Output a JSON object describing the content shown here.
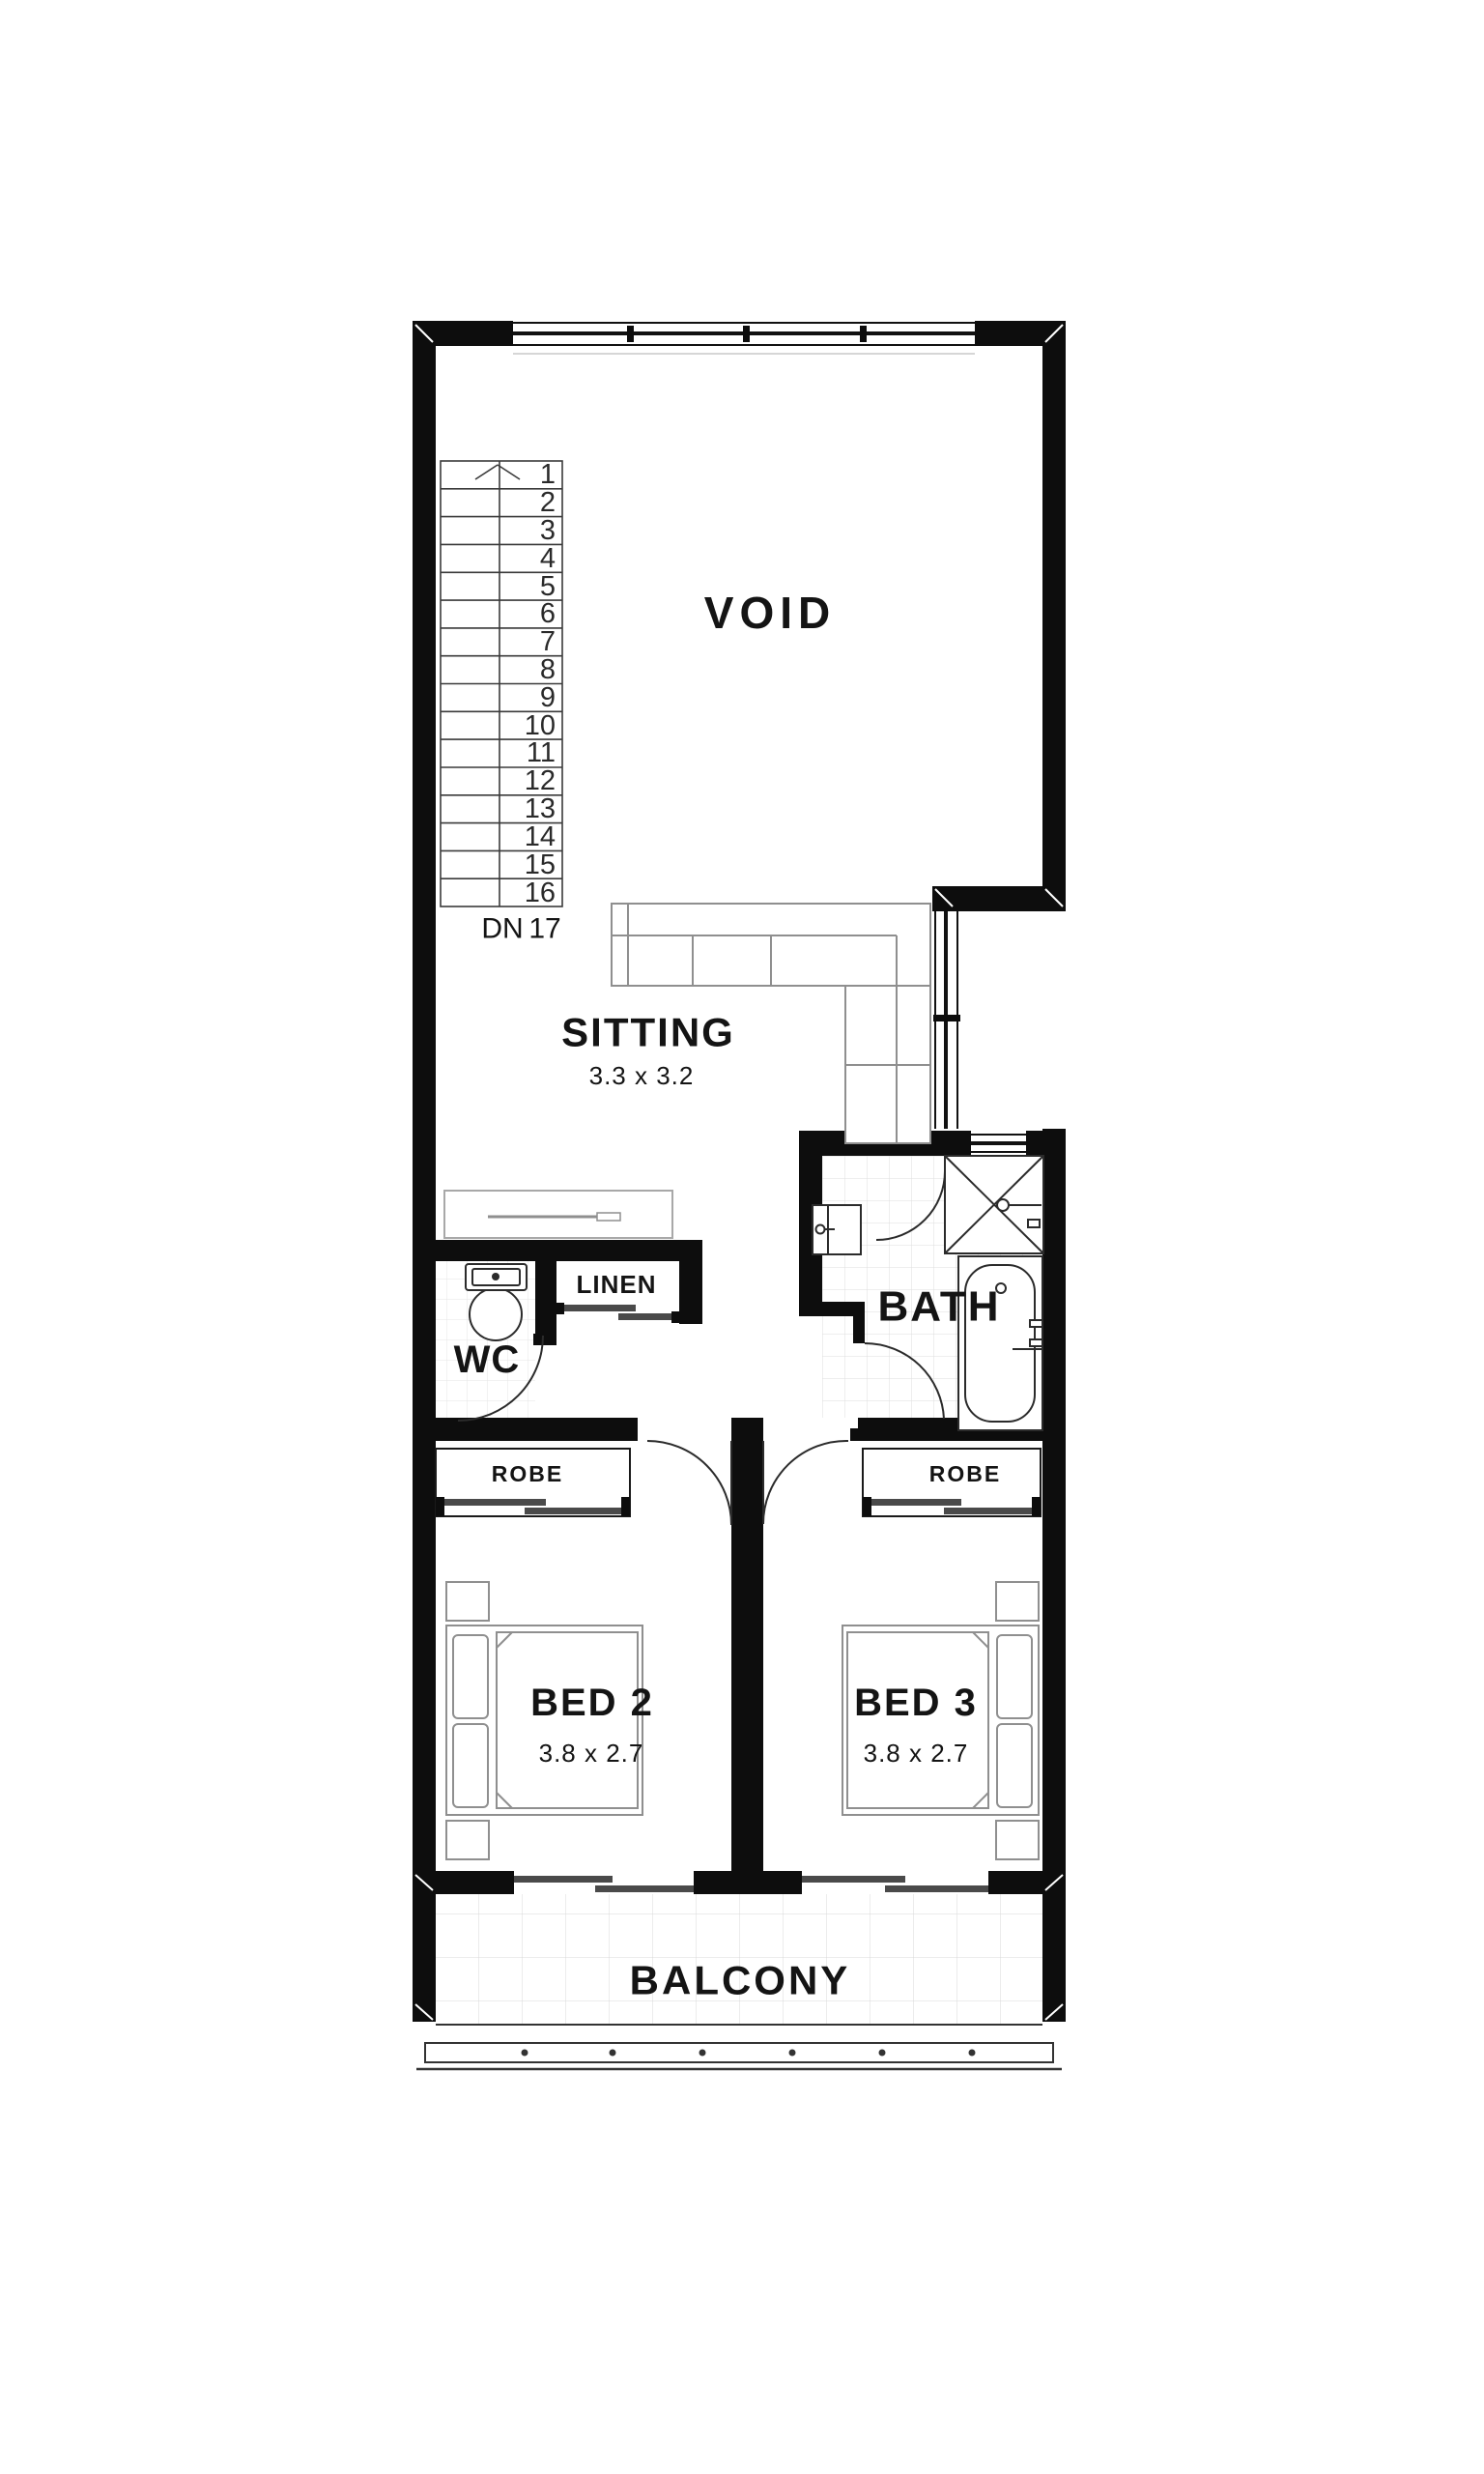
{
  "document": {
    "type": "floor-plan",
    "floor": "upper-level"
  },
  "colors": {
    "background": "#ffffff",
    "wall": "#0d0d0d",
    "fixture_line": "#2b2b2b",
    "furniture_line": "#8f8f8f",
    "tile_line": "#e0e0e0",
    "label_text": "#141414"
  },
  "rooms": {
    "void": {
      "label": "VOID"
    },
    "sitting": {
      "label": "SITTING",
      "dimensions": "3.3 x 3.2"
    },
    "wc": {
      "label": "WC"
    },
    "linen": {
      "label": "LINEN"
    },
    "bath": {
      "label": "BATH"
    },
    "robe_left": {
      "label": "ROBE"
    },
    "robe_right": {
      "label": "ROBE"
    },
    "bed2": {
      "label": "BED 2",
      "dimensions": "3.8 x 2.7"
    },
    "bed3": {
      "label": "BED 3",
      "dimensions": "3.8 x 2.7"
    },
    "balcony": {
      "label": "BALCONY"
    }
  },
  "stairs": {
    "down_label": "DN",
    "landing_step": "17",
    "steps": [
      "1",
      "2",
      "3",
      "4",
      "5",
      "6",
      "7",
      "8",
      "9",
      "10",
      "11",
      "12",
      "13",
      "14",
      "15",
      "16"
    ]
  }
}
